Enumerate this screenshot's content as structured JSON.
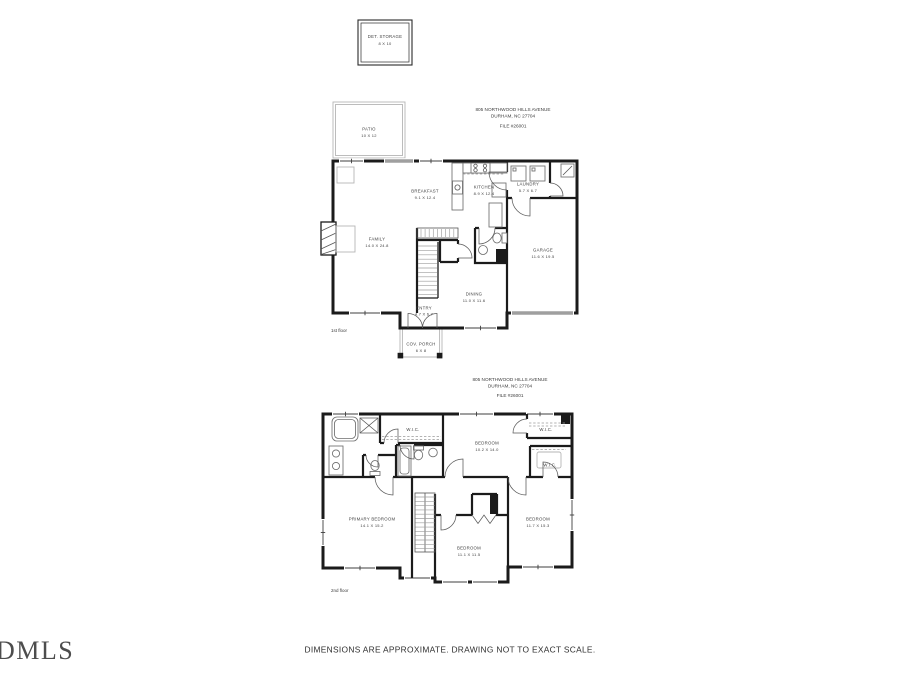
{
  "det_storage": {
    "name": "DET. STORAGE",
    "dims": "8 X 10"
  },
  "address1": {
    "street": "805 NORTHWOOD HILLS AVENUE",
    "city": "DURHAM, NC 27704",
    "file": "FILE #26001"
  },
  "address2": {
    "street": "805 NORTHWOOD HILLS AVENUE",
    "city": "DURHAM, NC 27704",
    "file": "FILE #26001"
  },
  "floor1": {
    "tag": "1st floor",
    "rooms": {
      "patio": {
        "name": "PATIO",
        "dims": "10 X 12"
      },
      "breakfast": {
        "name": "BREAKFAST",
        "dims": "9.1 X 12.4"
      },
      "kitchen": {
        "name": "KITCHEN",
        "dims": "8.9 X 12.4"
      },
      "laundry": {
        "name": "LAUNDRY",
        "dims": "5.7 X 6.7"
      },
      "family": {
        "name": "FAMILY",
        "dims": "14.0 X 24.8"
      },
      "garage": {
        "name": "GARAGE",
        "dims": "11.6 X 19.5"
      },
      "dining": {
        "name": "DINING",
        "dims": "11.0 X 11.6"
      },
      "entry": {
        "name": "ENTRY",
        "dims": "4.7 X 6.7"
      },
      "porch": {
        "name": "COV. PORCH",
        "dims": "6 X 8"
      }
    }
  },
  "floor2": {
    "tag": "2nd floor",
    "rooms": {
      "wic1": {
        "name": "W.I.C."
      },
      "wic2": {
        "name": "W.I.C."
      },
      "wic3": {
        "name": "W.I.C."
      },
      "bedroom2": {
        "name": "BEDROOM",
        "dims": "10.2 X 14.0"
      },
      "primary": {
        "name": "PRIMARY BEDROOM",
        "dims": "14.1 X 15.2"
      },
      "bedroom3": {
        "name": "BEDROOM",
        "dims": "11.7 X 15.3"
      },
      "bedroom4": {
        "name": "BEDROOM",
        "dims": "11.1 X 11.5"
      }
    }
  },
  "footer": {
    "disclaimer": "DIMENSIONS ARE APPROXIMATE. DRAWING NOT TO EXACT SCALE.",
    "logo": "DMLS"
  },
  "colors": {
    "wall": "#1b1b1b",
    "light_wall": "#b5b5b5",
    "text": "#414141"
  }
}
